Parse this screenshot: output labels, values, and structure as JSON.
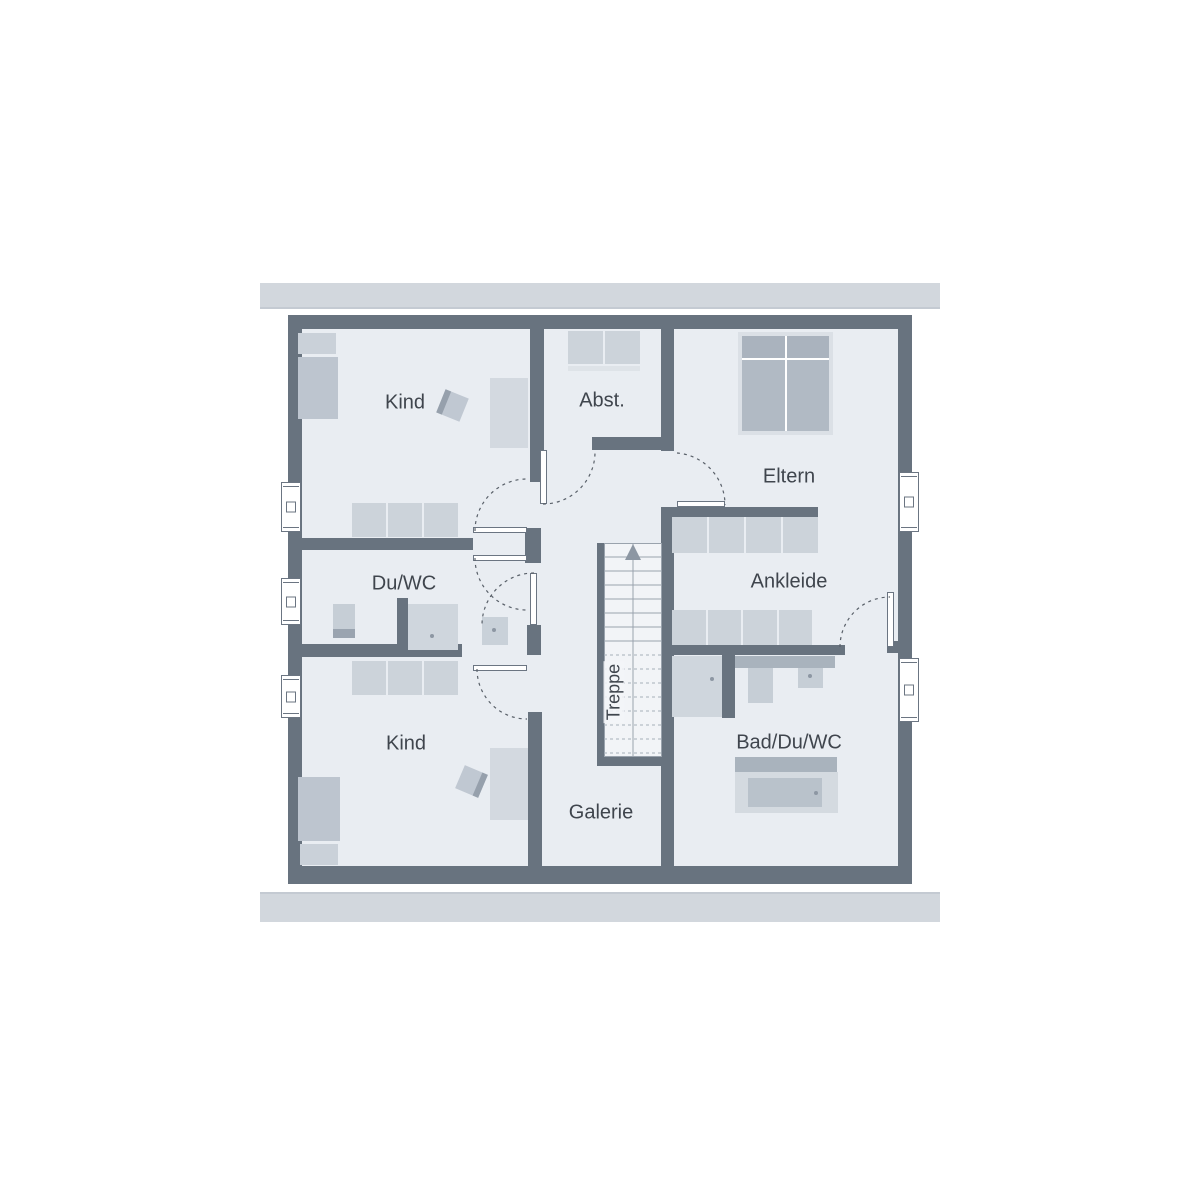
{
  "plan": {
    "title": "Obergeschoss Grundriss",
    "rooms": {
      "kind_top": {
        "label": "Kind"
      },
      "abstellraum": {
        "label": "Abst."
      },
      "eltern": {
        "label": "Eltern"
      },
      "du_wc": {
        "label": "Du/WC"
      },
      "ankleide": {
        "label": "Ankleide"
      },
      "kind_bottom": {
        "label": "Kind"
      },
      "galerie": {
        "label": "Galerie"
      },
      "bad_du_wc": {
        "label": "Bad/Du/WC"
      },
      "treppe": {
        "label": "Treppe"
      }
    },
    "colors": {
      "wall": "#68737f",
      "floor": "#e9edf2",
      "bar": "#d2d7dd",
      "furn_light": "#d3d9e0",
      "furn_mid": "#ccd3da",
      "furn_dark": "#aab3be",
      "furn_frame": "#dbe0e6",
      "stair_fill": "#f2f4f7",
      "stair_line": "#9aa3ad",
      "text": "#3f454d"
    }
  }
}
